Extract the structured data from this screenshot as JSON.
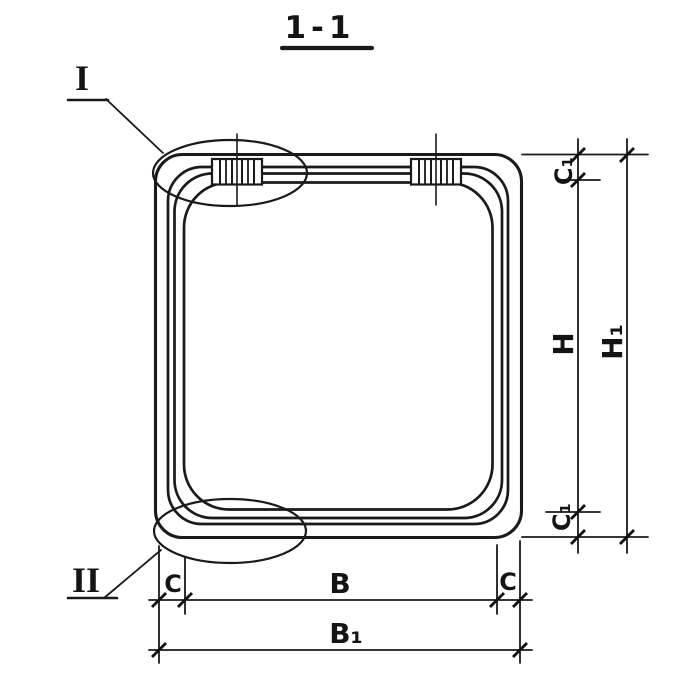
{
  "canvas": {
    "background": "#ffffff",
    "ink": "#1a1a1a"
  },
  "title": {
    "text": "1-1"
  },
  "callouts": {
    "top": {
      "label": "I"
    },
    "bottom": {
      "label": "II"
    }
  },
  "dimensions": {
    "right": {
      "c1_top": "C₁",
      "h": "H",
      "h1": "H₁",
      "c1_bottom": "C₁"
    },
    "bottom": {
      "c_left": "C",
      "b": "B",
      "c_right": "C",
      "b1": "B₁"
    }
  }
}
